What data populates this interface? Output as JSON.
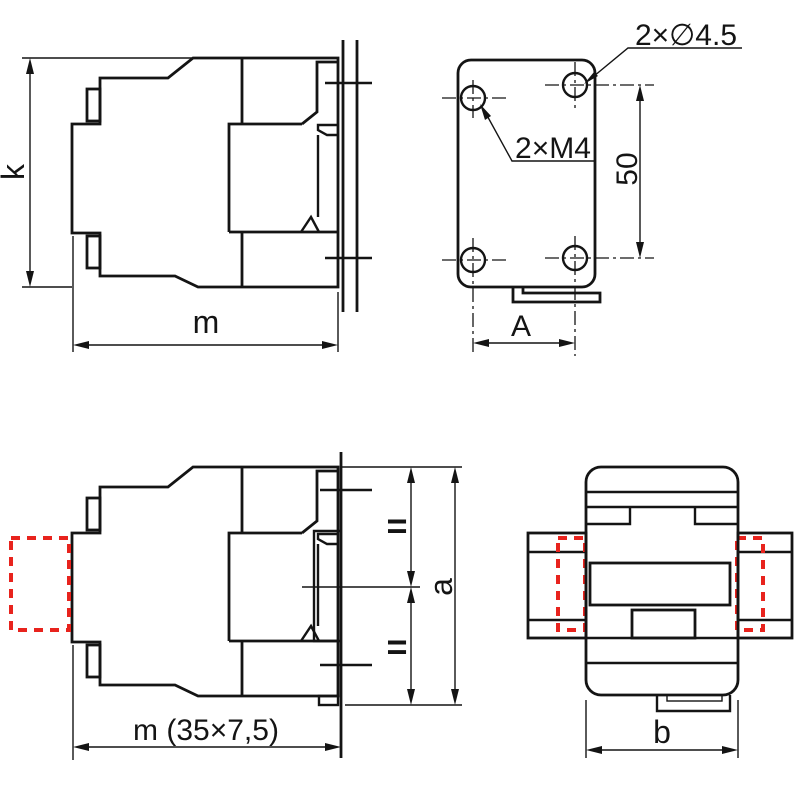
{
  "page": {
    "background": "#ffffff"
  },
  "drawing": {
    "line_color": "#141414",
    "accessory_color": "#e8231d",
    "views": {
      "side_top": {
        "height_label": "k",
        "width_label": "m"
      },
      "mounting_plate": {
        "drill_label": "2×∅4.5",
        "thread_label": "2×M4",
        "vertical_pitch_label": "50",
        "horizontal_pitch_label": "A"
      },
      "side_bottom": {
        "width_label": "m (35×7,5)",
        "upper_equal_label": "=",
        "lower_equal_label": "=",
        "height_label": "a"
      },
      "top_view": {
        "width_label": "b"
      }
    }
  }
}
